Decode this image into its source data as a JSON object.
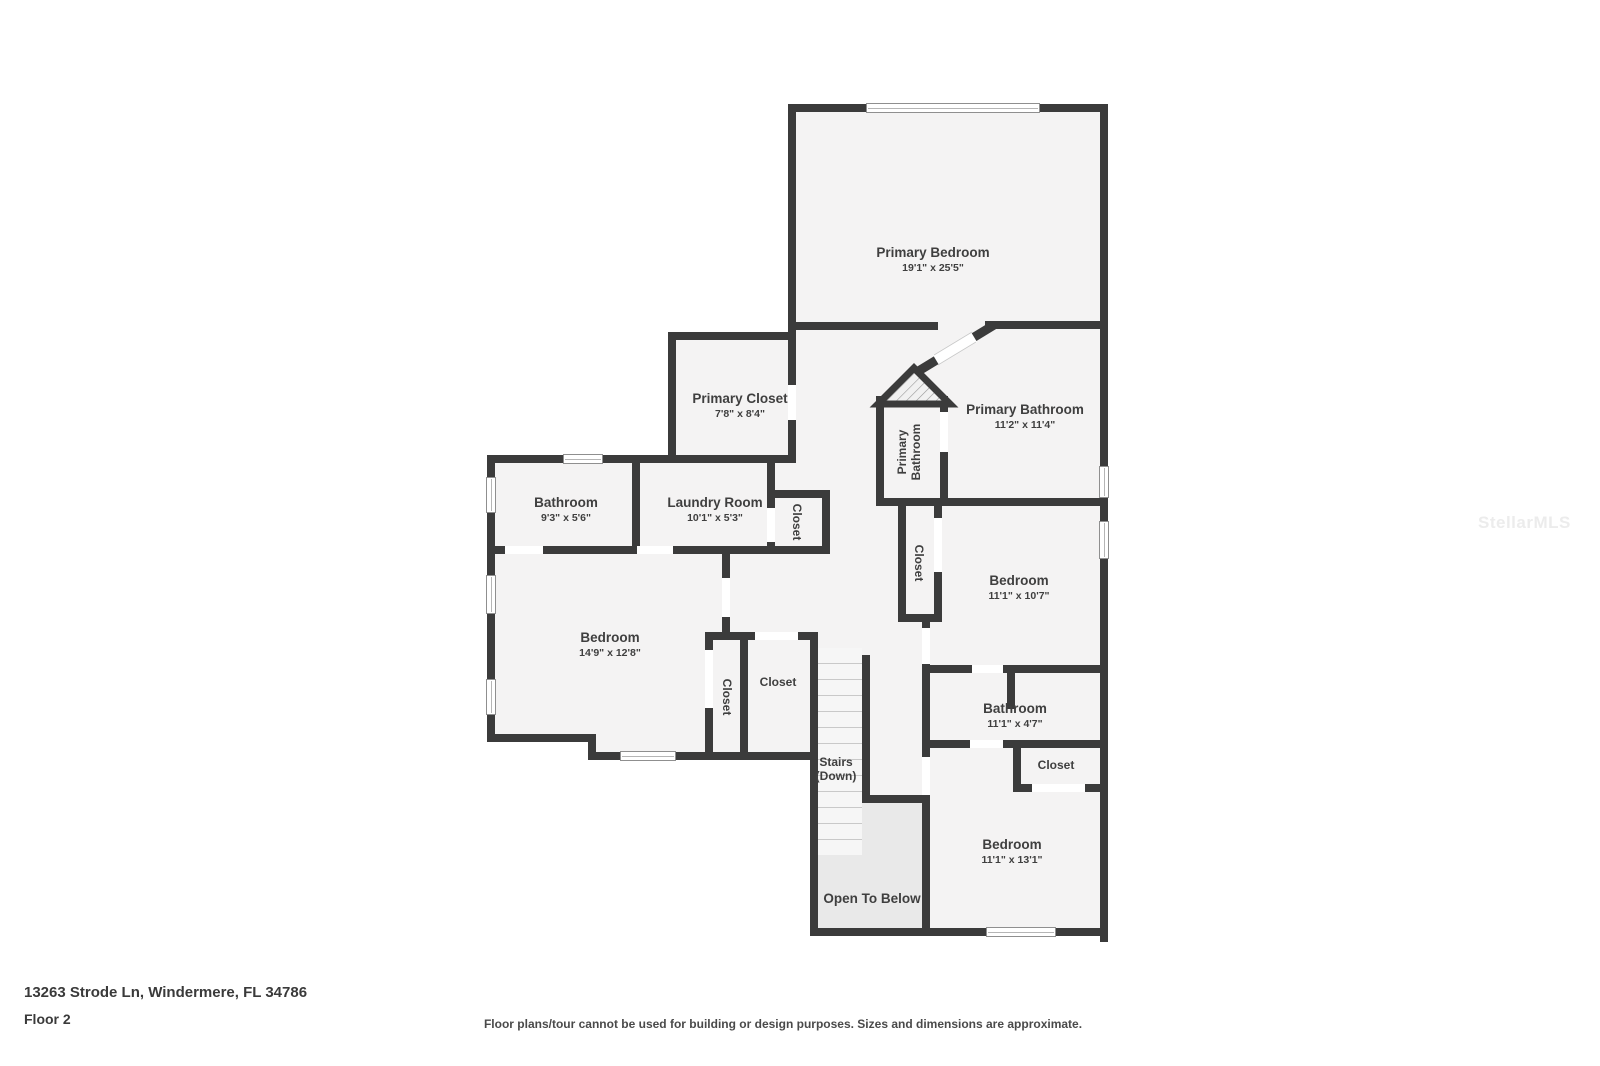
{
  "colors": {
    "wall": "#3b3b3b",
    "room_fill": "#f4f3f3",
    "open_fill": "#e9e9e9",
    "label": "#3f3f3f"
  },
  "rooms": {
    "primary_bedroom": {
      "label": "Primary Bedroom",
      "dims": "19'1\" x 25'5\""
    },
    "primary_closet": {
      "label": "Primary Closet",
      "dims": "7'8\" x 8'4\""
    },
    "primary_bathroom": {
      "label": "Primary Bathroom",
      "dims": "11'2\" x 11'4\""
    },
    "primary_bathroom_wc": {
      "line1": "Primary",
      "line2": "Bathroom"
    },
    "bathroom_left": {
      "label": "Bathroom",
      "dims": "9'3\" x 5'6\""
    },
    "laundry": {
      "label": "Laundry Room",
      "dims": "10'1\" x 5'3\""
    },
    "closet_laundry": {
      "label": "Closet"
    },
    "bedroom_left": {
      "label": "Bedroom",
      "dims": "14'9\" x 12'8\""
    },
    "closet_left_a": {
      "label": "Closet"
    },
    "closet_left_b": {
      "label": "Closet"
    },
    "closet_mid": {
      "label": "Closet"
    },
    "bedroom_right": {
      "label": "Bedroom",
      "dims": "11'1\" x 10'7\""
    },
    "bathroom_right": {
      "label": "Bathroom",
      "dims": "11'1\" x 4'7\""
    },
    "closet_right": {
      "label": "Closet"
    },
    "bedroom_bottom": {
      "label": "Bedroom",
      "dims": "11'1\" x 13'1\""
    },
    "stairs": {
      "label": "Stairs",
      "sub": "(Down)"
    },
    "open_to_below": {
      "label": "Open To Below"
    }
  },
  "footer": {
    "address": "13263 Strode Ln, Windermere, FL 34786",
    "floor": "Floor 2",
    "disclaimer": "Floor plans/tour cannot be used for building or design purposes. Sizes and dimensions are approximate."
  },
  "watermark": "StellarMLS"
}
